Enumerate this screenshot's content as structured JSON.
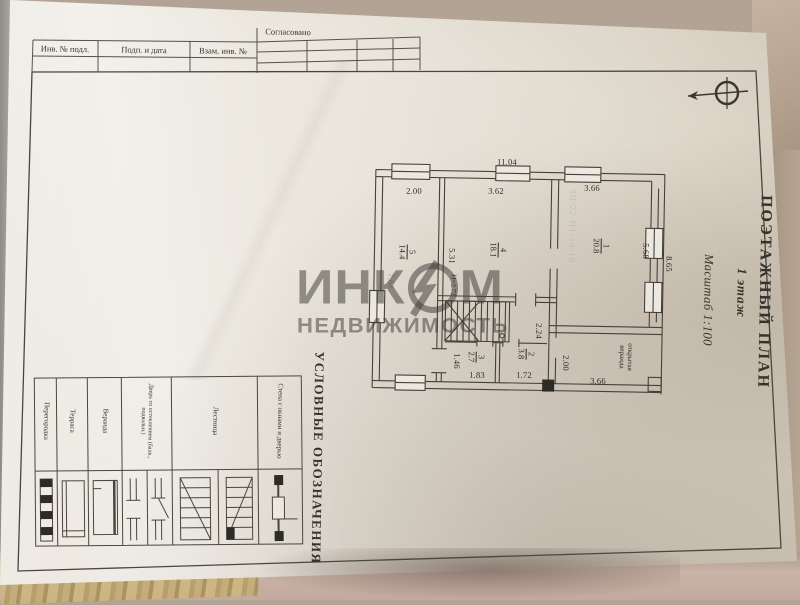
{
  "document": {
    "approval_label": "Согласовано",
    "inv_table": {
      "col1": "Инв. № подл.",
      "col2": "Подп. и дата",
      "col3": "Взам. инв. №"
    },
    "title_block": {
      "title": "ПОЭТАЖНЫЙ ПЛАН",
      "subtitle": "1 этаж",
      "scale": "Масштаб 1:100"
    },
    "stamp_faint": "ЗП/22-П1-10/10"
  },
  "watermark": {
    "part1": "ИНК",
    "part2": "М",
    "line2": "НЕДВИЖИМОСТЬ"
  },
  "plan": {
    "overall_width": "11.04",
    "rooms": [
      {
        "num": "5",
        "area": "14.4",
        "width": "2.00",
        "height_dim": "7.68"
      },
      {
        "num": "4",
        "area": "18.1",
        "width": "3.62",
        "depth": "5.31",
        "ceiling": "Н=2.72"
      },
      {
        "num": "1",
        "area": "20.8",
        "width": "3.66",
        "depth": "5.68",
        "outer": "8.65"
      },
      {
        "num": "3",
        "area": "2.7",
        "width": "1.83",
        "depth": "1.46"
      },
      {
        "num": "2",
        "area": "3.8",
        "width": "1.72",
        "depth": "2.24"
      }
    ],
    "veranda": {
      "label": "открытая веранда",
      "width": "3.66",
      "depth": "2.00"
    }
  },
  "legend": {
    "title": "УСЛОВНЫЕ ОБОЗНАЧЕНИЯ",
    "items": [
      "Перегородка",
      "Терраса",
      "Веранда",
      "Дверь со остеклением (балк., подвальн.)",
      "Лестница",
      "Стена с окнами и дверью"
    ]
  }
}
